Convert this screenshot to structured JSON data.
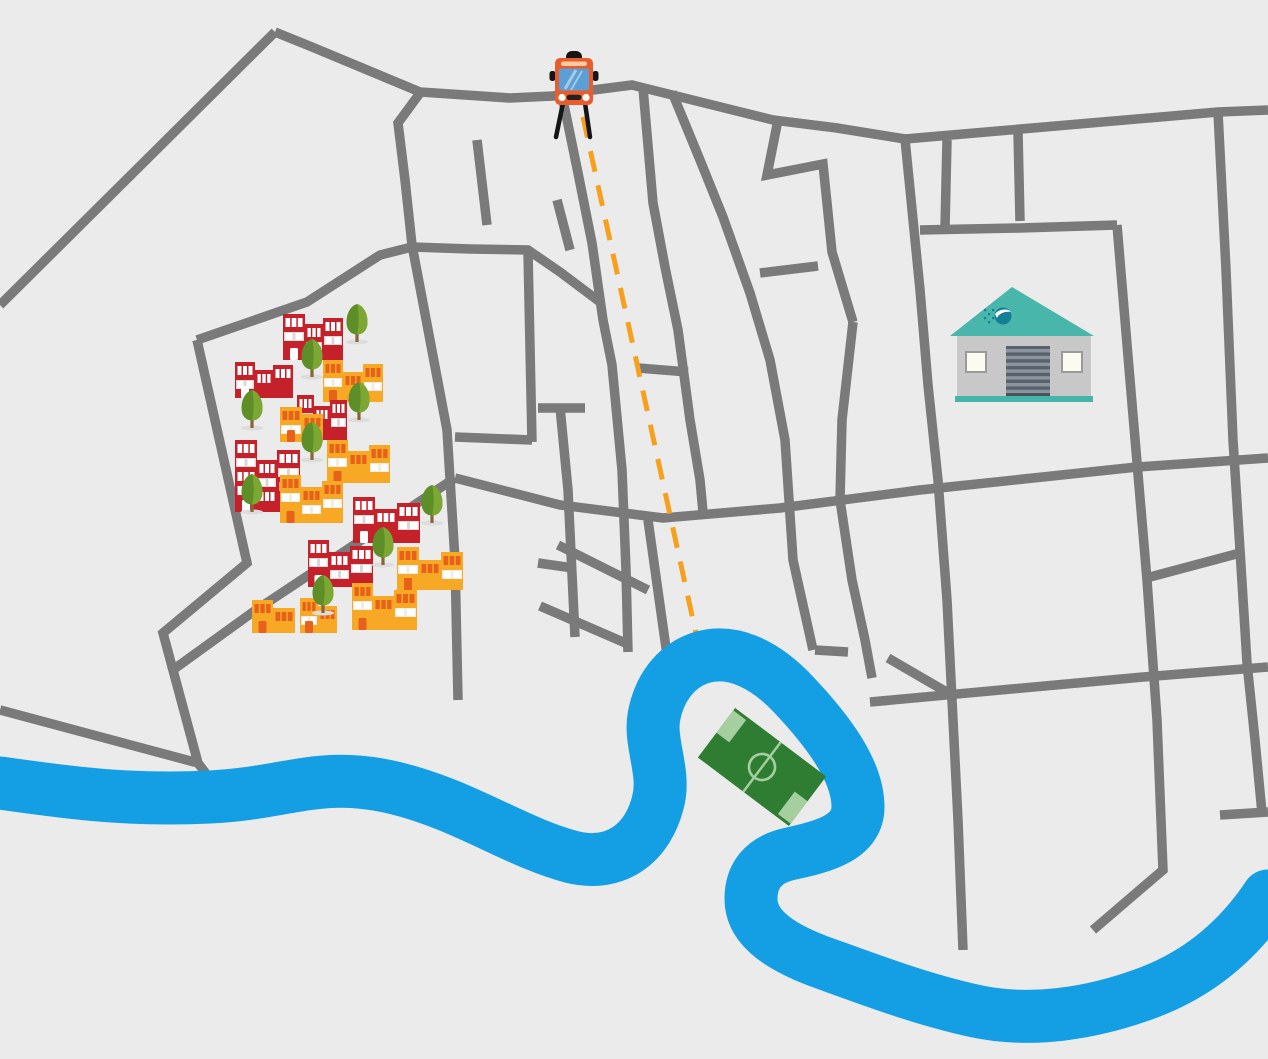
{
  "canvas": {
    "width": 1268,
    "height": 1059,
    "background_color": "#ebebeb"
  },
  "roads": {
    "color": "#7a7a7a",
    "width": 9.5,
    "polylines": [
      [
        [
          275,
          32
        ],
        [
          0,
          305
        ]
      ],
      [
        [
          275,
          32
        ],
        [
          312,
          47
        ],
        [
          420,
          92
        ],
        [
          510,
          98
        ],
        [
          553,
          96
        ],
        [
          593,
          90
        ],
        [
          632,
          85
        ],
        [
          773,
          120
        ],
        [
          837,
          128
        ],
        [
          905,
          139
        ]
      ],
      [
        [
          905,
          139
        ],
        [
          1218,
          112
        ],
        [
          1268,
          110
        ]
      ],
      [
        [
          905,
          139
        ],
        [
          920,
          290
        ],
        [
          928,
          385
        ],
        [
          938,
          480
        ],
        [
          947,
          600
        ],
        [
          952,
          700
        ],
        [
          958,
          820
        ],
        [
          963,
          950
        ]
      ],
      [
        [
          1218,
          112
        ],
        [
          1226,
          270
        ],
        [
          1233,
          440
        ],
        [
          1240,
          550
        ],
        [
          1247,
          663
        ],
        [
          1255,
          740
        ],
        [
          1262,
          813
        ]
      ],
      [
        [
          1220,
          815
        ],
        [
          1268,
          812
        ]
      ],
      [
        [
          920,
          230
        ],
        [
          1020,
          228
        ],
        [
          1117,
          225
        ]
      ],
      [
        [
          1117,
          225
        ],
        [
          1130,
          380
        ],
        [
          1147,
          580
        ],
        [
          1157,
          720
        ],
        [
          1163,
          870
        ],
        [
          1093,
          930
        ]
      ],
      [
        [
          455,
          478
        ],
        [
          560,
          505
        ],
        [
          663,
          518
        ],
        [
          780,
          508
        ],
        [
          920,
          490
        ],
        [
          1137,
          467
        ],
        [
          1268,
          458
        ]
      ],
      [
        [
          1150,
          577
        ],
        [
          1240,
          553
        ]
      ],
      [
        [
          870,
          702
        ],
        [
          1143,
          677
        ],
        [
          1268,
          667
        ]
      ],
      [
        [
          888,
          658
        ],
        [
          950,
          694
        ]
      ],
      [
        [
          947,
          140
        ],
        [
          945,
          228
        ]
      ],
      [
        [
          1018,
          132
        ],
        [
          1020,
          221
        ]
      ],
      [
        [
          643,
          88
        ],
        [
          653,
          203
        ],
        [
          665,
          267
        ],
        [
          678,
          330
        ],
        [
          690,
          420
        ],
        [
          700,
          480
        ],
        [
          703,
          512
        ]
      ],
      [
        [
          672,
          92
        ],
        [
          700,
          160
        ],
        [
          723,
          217
        ],
        [
          750,
          293
        ],
        [
          770,
          360
        ],
        [
          785,
          440
        ],
        [
          793,
          560
        ],
        [
          813,
          650
        ]
      ],
      [
        [
          778,
          120
        ],
        [
          767,
          175
        ],
        [
          823,
          164
        ],
        [
          832,
          252
        ],
        [
          853,
          322
        ]
      ],
      [
        [
          853,
          322
        ],
        [
          842,
          420
        ],
        [
          840,
          500
        ],
        [
          852,
          580
        ],
        [
          865,
          640
        ],
        [
          872,
          678
        ]
      ],
      [
        [
          815,
          650
        ],
        [
          848,
          652
        ]
      ],
      [
        [
          760,
          273
        ],
        [
          818,
          266
        ]
      ],
      [
        [
          563,
          100
        ],
        [
          578,
          173
        ],
        [
          592,
          243
        ],
        [
          603,
          320
        ],
        [
          612,
          365
        ],
        [
          622,
          470
        ],
        [
          626,
          570
        ],
        [
          628,
          652
        ]
      ],
      [
        [
          412,
          247
        ],
        [
          470,
          249
        ],
        [
          528,
          250
        ],
        [
          560,
          272
        ],
        [
          600,
          302
        ]
      ],
      [
        [
          420,
          93
        ],
        [
          398,
          123
        ],
        [
          405,
          180
        ],
        [
          412,
          245
        ]
      ],
      [
        [
          412,
          245
        ],
        [
          447,
          430
        ],
        [
          455,
          560
        ],
        [
          458,
          700
        ]
      ],
      [
        [
          528,
          252
        ],
        [
          532,
          442
        ]
      ],
      [
        [
          532,
          440
        ],
        [
          455,
          437
        ]
      ],
      [
        [
          477,
          140
        ],
        [
          487,
          225
        ]
      ],
      [
        [
          557,
          200
        ],
        [
          570,
          250
        ]
      ],
      [
        [
          538,
          408
        ],
        [
          585,
          408
        ]
      ],
      [
        [
          560,
          407
        ],
        [
          568,
          490
        ],
        [
          575,
          637
        ]
      ],
      [
        [
          538,
          563
        ],
        [
          573,
          568
        ]
      ],
      [
        [
          558,
          545
        ],
        [
          648,
          590
        ]
      ],
      [
        [
          540,
          606
        ],
        [
          630,
          645
        ]
      ],
      [
        [
          648,
          520
        ],
        [
          667,
          655
        ]
      ],
      [
        [
          638,
          368
        ],
        [
          688,
          372
        ]
      ],
      [
        [
          197,
          340
        ],
        [
          247,
          563
        ],
        [
          163,
          633
        ],
        [
          198,
          763
        ],
        [
          207,
          775
        ]
      ],
      [
        [
          0,
          710
        ],
        [
          198,
          763
        ]
      ],
      [
        [
          197,
          340
        ],
        [
          307,
          302
        ],
        [
          380,
          255
        ],
        [
          412,
          247
        ]
      ],
      [
        [
          455,
          478
        ],
        [
          253,
          612
        ],
        [
          170,
          672
        ]
      ]
    ]
  },
  "river": {
    "color": "#149fe4",
    "width": 53,
    "path": "M 0,783 C 70,793 130,801 210,797 C 290,793 320,770 395,788 C 465,805 515,842 572,857 C 617,868 648,842 658,802 C 666,772 649,744 654,716 C 659,690 674,667 700,658 C 734,647 768,667 794,695 C 827,730 858,770 858,807 C 858,838 822,847 789,854 C 763,860 751,876 751,899 C 751,924 773,944 818,961 C 868,979 920,999 975,1011 C 1030,1023 1092,1014 1150,992 C 1202,972 1240,938 1268,896"
  },
  "route": {
    "color": "#f7a01e",
    "width": 5,
    "dash": "21 14",
    "from": [
      583,
      117
    ],
    "to": [
      700,
      652
    ]
  },
  "bus": {
    "x": 574,
    "y": 81,
    "body_color": "#e95c2c",
    "windshield_color": "#5c9fd6",
    "roof_stripe_color": "#f7cba4",
    "detail_color": "#151515",
    "light_color": "#ffffff"
  },
  "warehouse": {
    "roof_color": "#49b6ab",
    "body_color": "#c8c8c8",
    "base_color": "#45b5aa",
    "door_color": "#59616c",
    "door_slat_color": "#8c949d",
    "window_color": "#fbfbef",
    "window_frame_color": "#9a9a9a",
    "logo_color": "#157f95",
    "apex": [
      1012,
      287
    ],
    "roof_left": [
      950,
      336
    ],
    "roof_right": [
      1094,
      336
    ],
    "body_rect": [
      957,
      336,
      134,
      60
    ],
    "base_rect": [
      955,
      396,
      138,
      6
    ],
    "door_rect": [
      1006,
      346,
      44,
      50
    ],
    "windows": [
      [
        966,
        352,
        20,
        20
      ],
      [
        1062,
        352,
        20,
        20
      ]
    ]
  },
  "soccer_field": {
    "cx": 762,
    "cy": 767,
    "width": 114,
    "height": 62,
    "rotation_deg": 37,
    "grass_color": "#2f7d33",
    "light_color": "#a6cfa0",
    "circle_radius": 13
  },
  "buildings": {
    "palettes": {
      "red": {
        "body": "#c5212a",
        "window": "#ffffff",
        "band": "#d8d8d8",
        "band_window": "#ffffff",
        "door": "#ffffff"
      },
      "orange": {
        "body": "#f7a824",
        "window": "#e8611b",
        "band": "#f2ede4",
        "band_window": "#ffffff",
        "door": "#e8611b"
      }
    },
    "items": [
      {
        "x": 283,
        "y": 360,
        "palette": "red",
        "towers": [
          [
            0,
            22,
            46
          ],
          [
            22,
            18,
            36
          ],
          [
            40,
            20,
            42
          ]
        ]
      },
      {
        "x": 235,
        "y": 398,
        "palette": "red",
        "towers": [
          [
            0,
            20,
            36
          ],
          [
            20,
            18,
            28
          ],
          [
            38,
            20,
            33
          ]
        ]
      },
      {
        "x": 323,
        "y": 402,
        "palette": "orange",
        "towers": [
          [
            0,
            20,
            42
          ],
          [
            20,
            20,
            30
          ],
          [
            40,
            20,
            38
          ]
        ]
      },
      {
        "x": 297,
        "y": 440,
        "palette": "red",
        "towers": [
          [
            0,
            17,
            45
          ],
          [
            17,
            16,
            34
          ],
          [
            33,
            17,
            40
          ]
        ]
      },
      {
        "x": 280,
        "y": 442,
        "palette": "orange",
        "towers": [
          [
            0,
            22,
            35
          ],
          [
            22,
            21,
            28
          ]
        ]
      },
      {
        "x": 327,
        "y": 483,
        "palette": "orange",
        "towers": [
          [
            0,
            21,
            43
          ],
          [
            21,
            21,
            32
          ],
          [
            42,
            21,
            38
          ]
        ]
      },
      {
        "x": 235,
        "y": 512,
        "palette": "red",
        "towers": [
          [
            0,
            22,
            72
          ],
          [
            22,
            20,
            52
          ],
          [
            42,
            23,
            62
          ]
        ]
      },
      {
        "x": 280,
        "y": 523,
        "palette": "orange",
        "towers": [
          [
            0,
            21,
            48
          ],
          [
            21,
            21,
            36
          ],
          [
            42,
            21,
            42
          ]
        ]
      },
      {
        "x": 353,
        "y": 543,
        "palette": "red",
        "towers": [
          [
            0,
            22,
            46
          ],
          [
            22,
            22,
            34
          ],
          [
            44,
            23,
            40
          ]
        ]
      },
      {
        "x": 397,
        "y": 590,
        "palette": "orange",
        "towers": [
          [
            0,
            22,
            43
          ],
          [
            22,
            22,
            30
          ],
          [
            44,
            22,
            38
          ]
        ]
      },
      {
        "x": 308,
        "y": 587,
        "palette": "red",
        "towers": [
          [
            0,
            21,
            47
          ],
          [
            21,
            21,
            35
          ],
          [
            42,
            23,
            41
          ]
        ]
      },
      {
        "x": 352,
        "y": 630,
        "palette": "orange",
        "towers": [
          [
            0,
            21,
            47
          ],
          [
            21,
            21,
            34
          ],
          [
            42,
            23,
            40
          ]
        ]
      },
      {
        "x": 252,
        "y": 633,
        "palette": "orange",
        "towers": [
          [
            0,
            21,
            33
          ],
          [
            21,
            22,
            25
          ]
        ]
      },
      {
        "x": 300,
        "y": 633,
        "palette": "orange",
        "towers": [
          [
            0,
            18,
            35
          ],
          [
            18,
            19,
            27
          ]
        ]
      }
    ]
  },
  "trees": {
    "canopy_dark": "#5e8e28",
    "canopy_light": "#7ca733",
    "trunk_color": "#8a6239",
    "shadow_color": "#dcdcdc",
    "positions": [
      [
        357,
        342
      ],
      [
        312,
        377
      ],
      [
        252,
        428
      ],
      [
        359,
        420
      ],
      [
        312,
        460
      ],
      [
        252,
        512
      ],
      [
        432,
        523
      ],
      [
        383,
        565
      ],
      [
        323,
        613
      ]
    ]
  }
}
